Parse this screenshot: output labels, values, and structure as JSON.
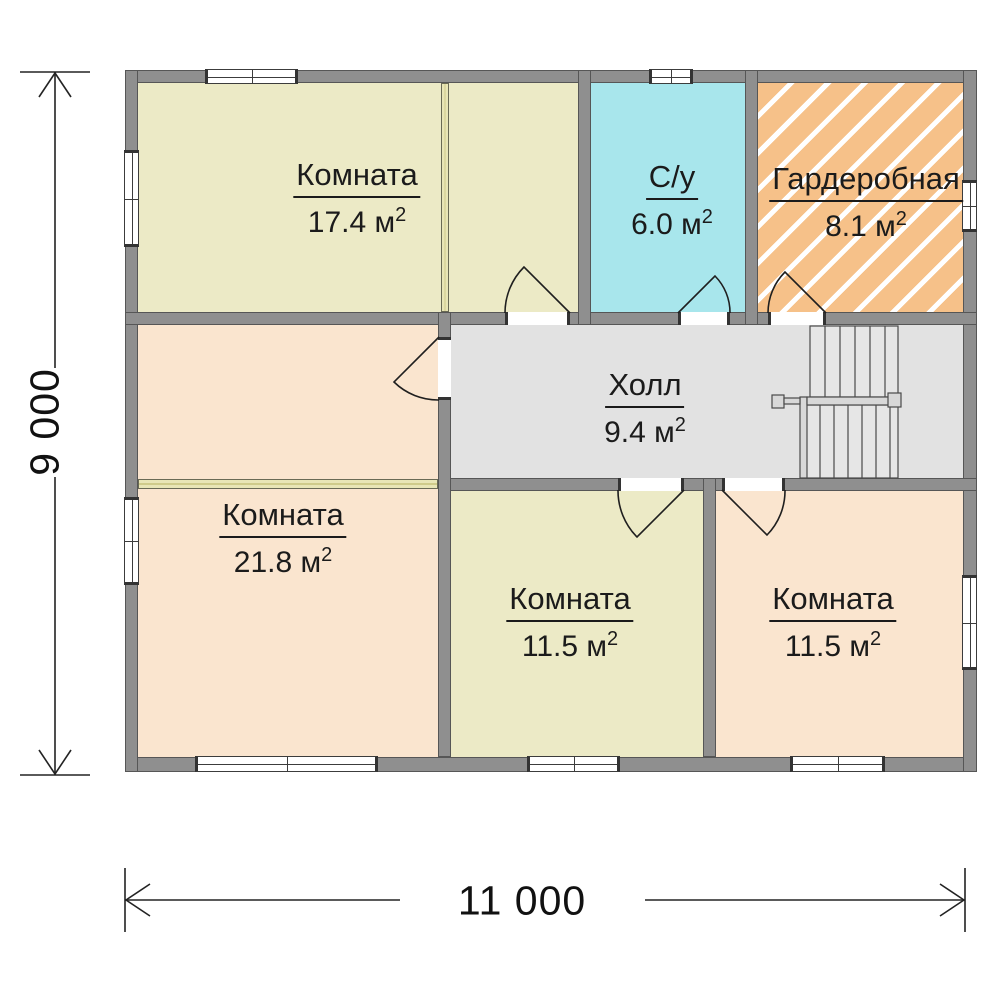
{
  "colors": {
    "wall": "#8f8f8f",
    "wall-border": "#565656",
    "room-yellow": "#eceac6",
    "room-peach": "#fae5cf",
    "room-cyan": "#a8e6ec",
    "room-orange": "#f6c189",
    "hall-gray": "#e2e2e2",
    "text": "#1b1b1b"
  },
  "rooms": [
    {
      "id": "room-17",
      "name": "Комната",
      "area": "17.4 м",
      "sup": "2"
    },
    {
      "id": "bathroom",
      "name": "С/у",
      "area": "6.0 м",
      "sup": "2"
    },
    {
      "id": "wardrobe",
      "name": "Гардеробная",
      "area": "8.1 м",
      "sup": "2"
    },
    {
      "id": "hall",
      "name": "Холл",
      "area": "9.4 м",
      "sup": "2"
    },
    {
      "id": "room-21",
      "name": "Комната",
      "area": "21.8 м",
      "sup": "2"
    },
    {
      "id": "room-11-center",
      "name": "Комната",
      "area": "11.5 м",
      "sup": "2"
    },
    {
      "id": "room-11-right",
      "name": "Комната",
      "area": "11.5 м",
      "sup": "2"
    }
  ],
  "dimensions": {
    "height_label": "9 000",
    "width_label": "11 000"
  }
}
